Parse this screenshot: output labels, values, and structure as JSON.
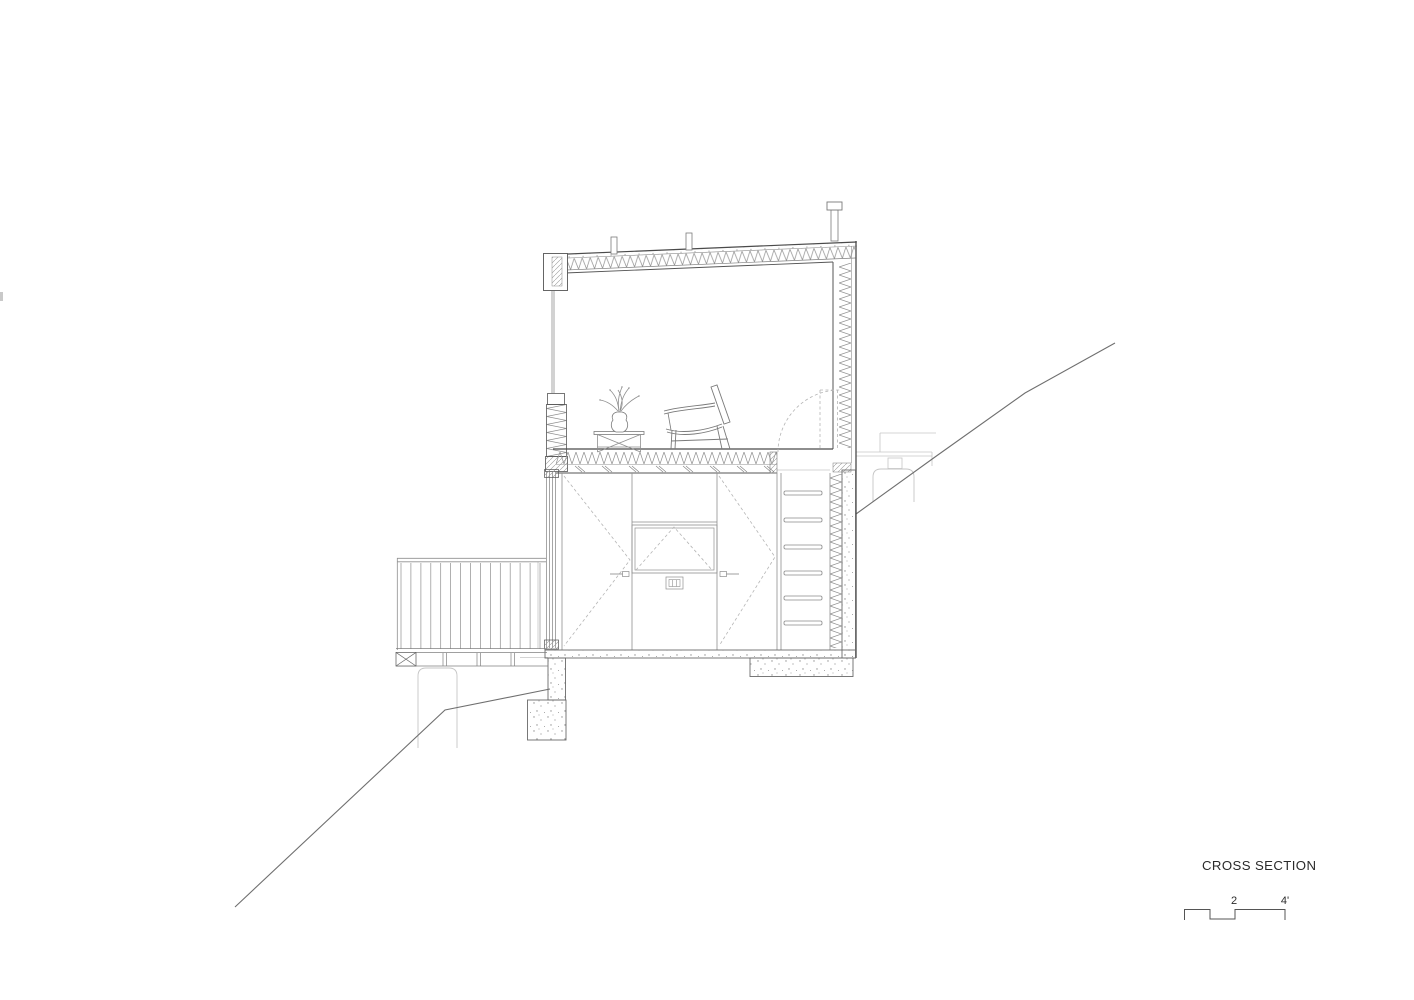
{
  "page": {
    "background": "#ffffff"
  },
  "drawing": {
    "kind": "architectural cross section of a two-level cabin on a sloped site",
    "parts": [
      "sloped-roof-with-batt-insulation",
      "chimney-flue",
      "roof-vents",
      "floor-to-ceiling-window",
      "insulated-spandrel-panel",
      "lounge-chair",
      "side-table",
      "plant-in-vase",
      "insulated-floor-assembly",
      "hatch-swing-dashed-arc",
      "built-in-cabinet-wall",
      "fold-down-niche-door",
      "wall-vent",
      "ladder",
      "glazed-door",
      "deck-guardrail",
      "deck-framing",
      "concrete-pier",
      "foundation-slab-and-footings",
      "terrain-slope-lines",
      "rear-terrace-ghost-lines"
    ]
  },
  "palette": {
    "cut_line": "#4a4a4a",
    "line": "#808080",
    "light_line": "#c6c6c6",
    "dashed_line": "#b5b5b5",
    "terrain_line": "#6f6f6f",
    "stipple": "#909090",
    "text": "#2b2b2b"
  },
  "title_block": {
    "title": "CROSS SECTION"
  },
  "scale_bar": {
    "mid_label": "2",
    "end_label": "4'"
  }
}
